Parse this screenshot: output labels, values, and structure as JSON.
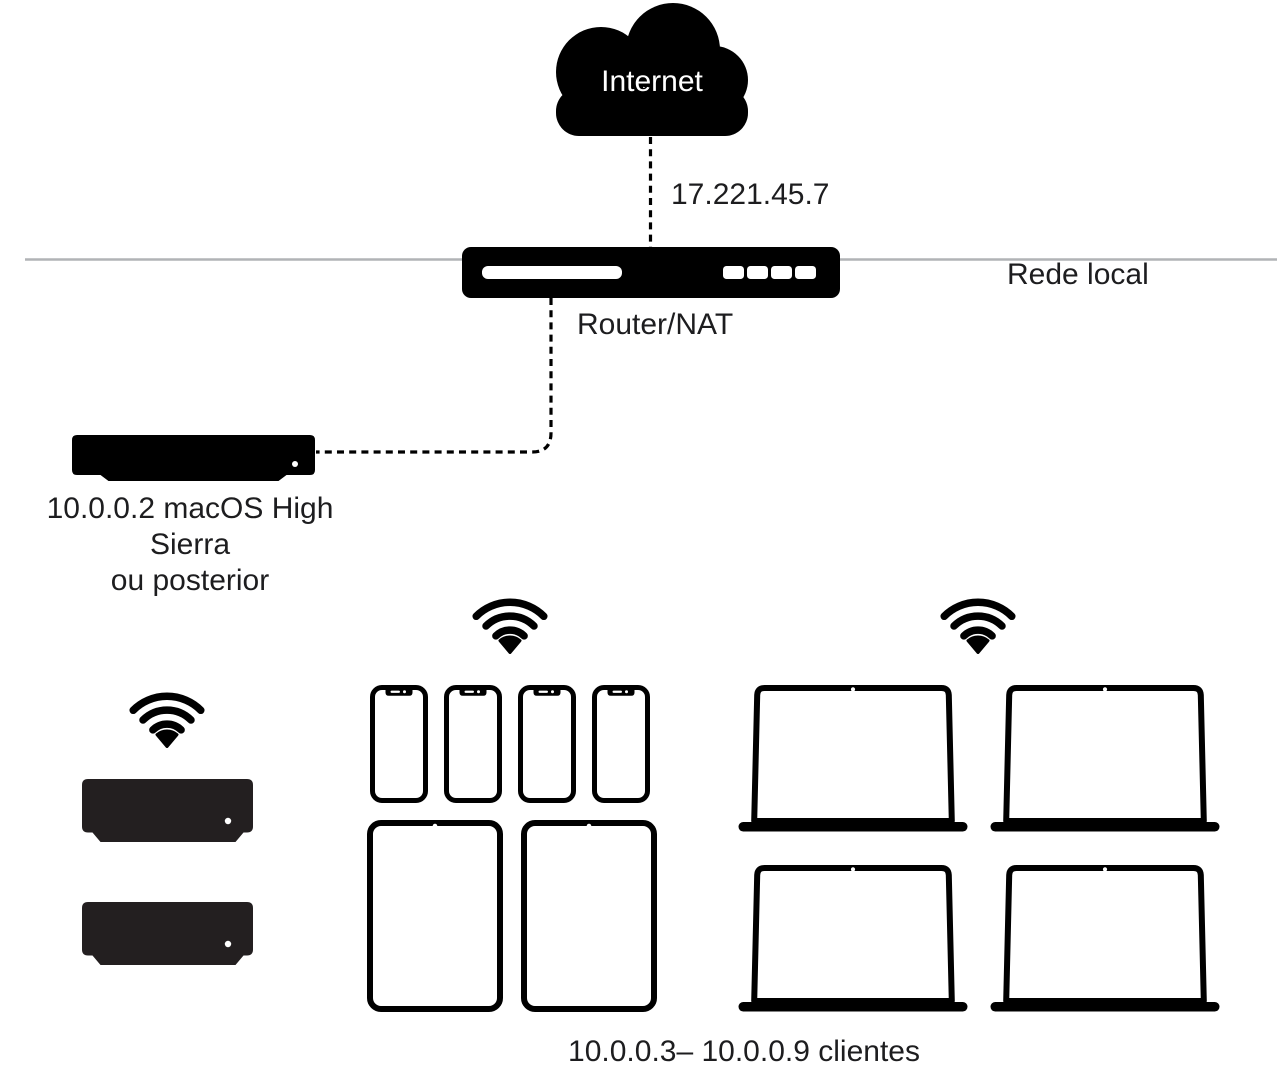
{
  "labels": {
    "internet": "Internet",
    "wan_ip": "17.221.45.7",
    "router": "Router/NAT",
    "lan": "Rede local",
    "server_line1": "10.0.0.2 macOS High Sierra",
    "server_line2": "ou posterior",
    "clients": "10.0.0.3– 10.0.0.9 clientes"
  },
  "colors": {
    "background": "#ffffff",
    "device_black": "#000000",
    "client_mac_mini_fill": "#231f20",
    "lan_line_gray": "#b1b3b6",
    "text": "#1d1d1f",
    "cloud_text": "#ffffff"
  },
  "connections": {
    "internet_to_router": "dashed vertical line",
    "router_to_server": "dashed elbow line",
    "lan": "solid gray horizontal line"
  },
  "icons": [
    "cloud-icon",
    "router-icon",
    "mac-mini-icon",
    "wifi-icon",
    "iphone-icon",
    "ipad-icon",
    "macbook-icon"
  ],
  "client_groups": [
    {
      "name": "mac-mini-group",
      "wifi": true,
      "devices": [
        {
          "type": "mac-mini",
          "count": 2
        }
      ]
    },
    {
      "name": "iphone-ipad-group",
      "wifi": true,
      "devices": [
        {
          "type": "iphone",
          "count": 4
        },
        {
          "type": "ipad",
          "count": 2
        }
      ]
    },
    {
      "name": "macbook-group",
      "wifi": true,
      "devices": [
        {
          "type": "macbook",
          "count": 4
        }
      ]
    }
  ]
}
